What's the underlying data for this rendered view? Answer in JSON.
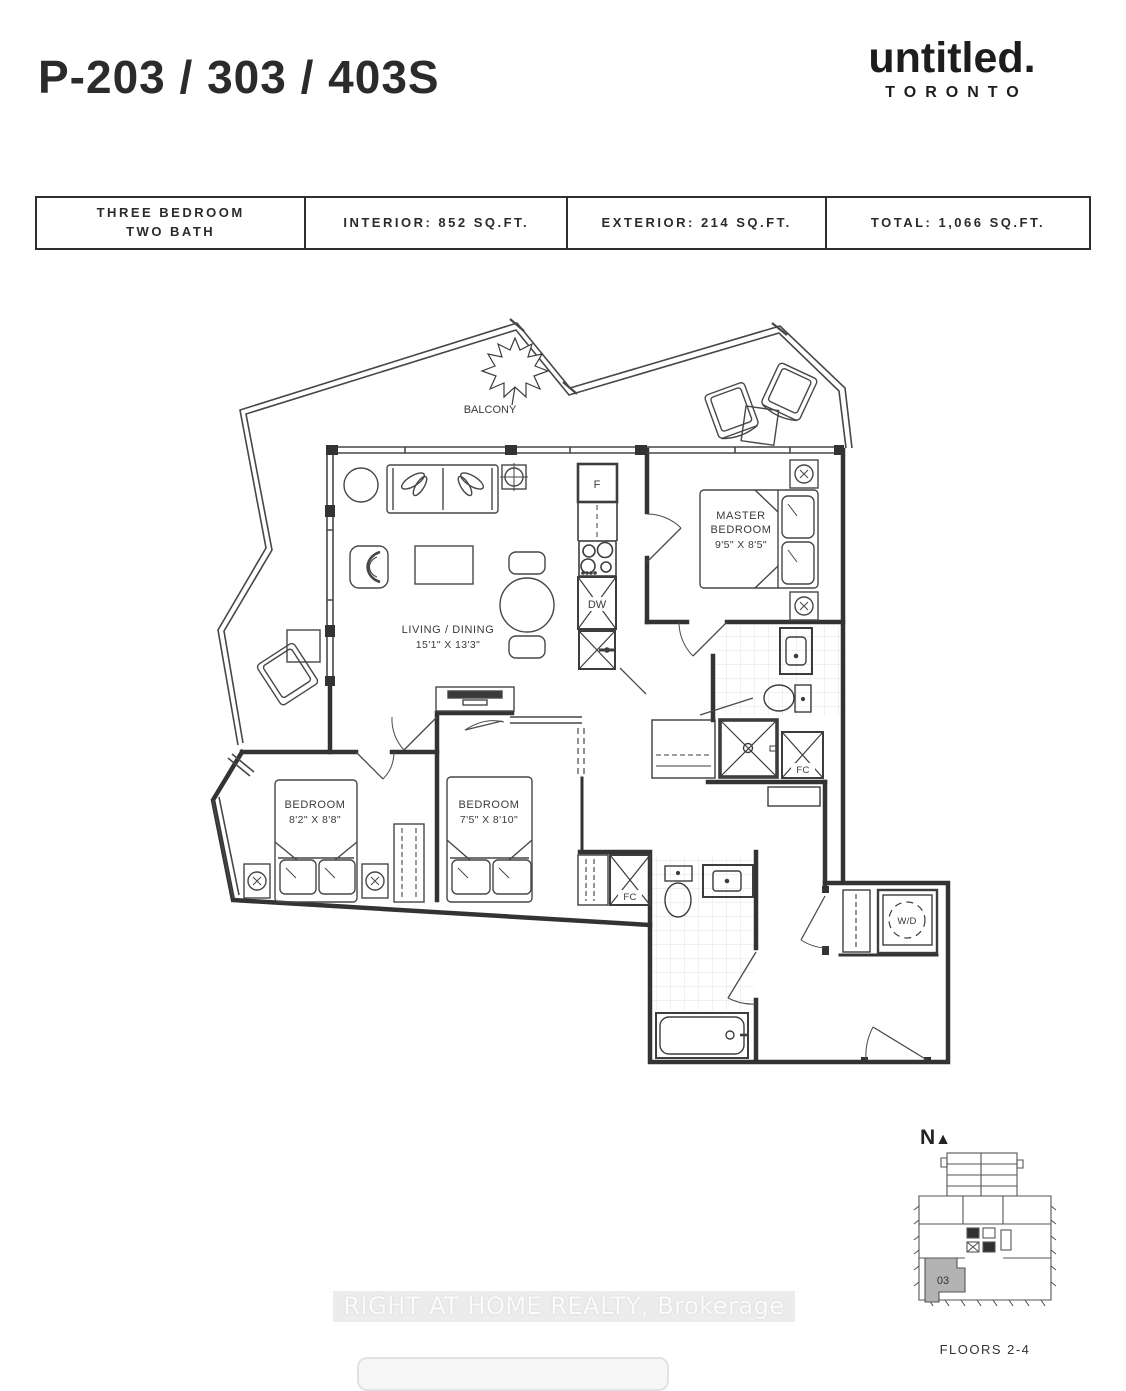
{
  "header": {
    "title": "P-203 / 303 / 403S",
    "logo_name": "untitled.",
    "logo_city": "TORONTO"
  },
  "info_table": {
    "col1_line1": "THREE BEDROOM",
    "col1_line2": "TWO BATH",
    "col2": "INTERIOR: 852 SQ.FT.",
    "col3": "EXTERIOR: 214 SQ.FT.",
    "col4": "TOTAL: 1,066 SQ.FT."
  },
  "floorplan": {
    "balcony_label": "BALCONY",
    "living": {
      "name": "LIVING / DINING",
      "dims": "15'1\" X 13'3\""
    },
    "master": {
      "line1": "MASTER",
      "line2": "BEDROOM",
      "dims": "9'5\" X 8'5\""
    },
    "bedroom2": {
      "name": "BEDROOM",
      "dims": "8'2\" X 8'8\""
    },
    "bedroom3": {
      "name": "BEDROOM",
      "dims": "7'5\" X 8'10\""
    },
    "fridge": "F",
    "dishwasher": "DW",
    "fan_coil": "FC",
    "washer_dryer": "W/D"
  },
  "keyplan": {
    "north_label": "N",
    "north_arrow": "▲",
    "unit_number": "03",
    "caption": "FLOORS 2-4"
  },
  "watermark": "RIGHT AT HOME REALTY, Brokerage",
  "colors": {
    "ink": "#2e2e2e",
    "wall": "#333333",
    "thin": "#4a4a4a",
    "unit_fill": "#b3b3b3",
    "watermark_bg": "#ececec"
  }
}
